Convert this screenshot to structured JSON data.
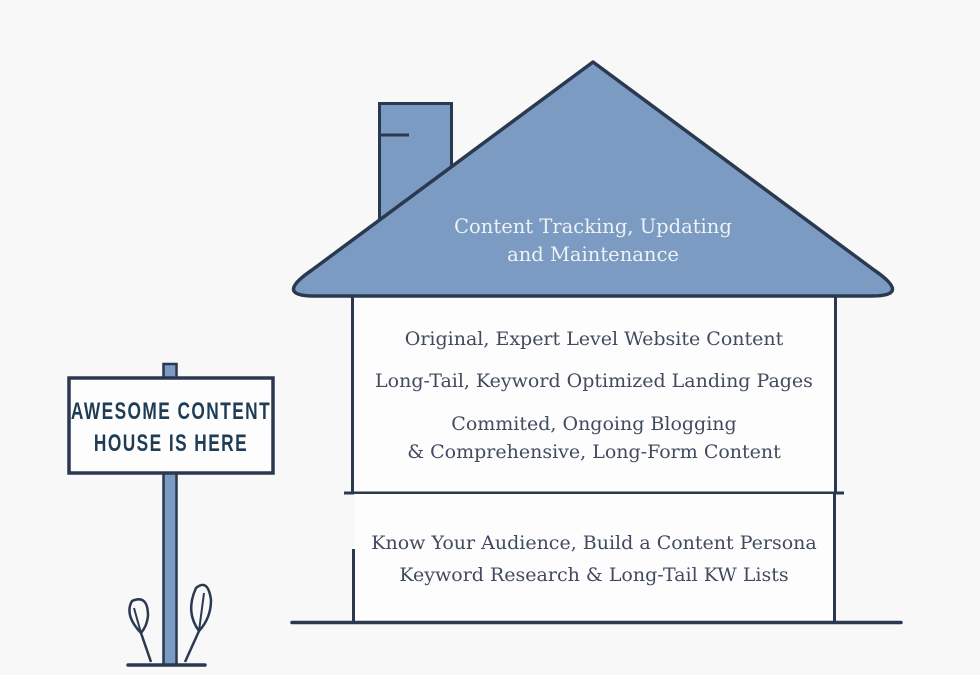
{
  "colors": {
    "background": "#f8f8f8",
    "roof_fill": "#7b9bc2",
    "outline": "#2b3950",
    "box_fill": "#fdfdfe",
    "body_text": "#414a5e",
    "roof_text": "#eff2f5",
    "sign_text": "#1f3c55"
  },
  "sign": {
    "line1": "AWESOME CONTENT",
    "line2": "HOUSE IS HERE"
  },
  "house": {
    "roof": {
      "line1": "Content Tracking, Updating",
      "line2": "and Maintenance"
    },
    "upper_floor": {
      "item1": "Original, Expert Level Website Content",
      "item2": "Long-Tail, Keyword Optimized Landing Pages",
      "item3_line1": "Commited, Ongoing Blogging",
      "item3_line2": "& Comprehensive, Long-Form Content"
    },
    "foundation": {
      "item1": "Know Your Audience, Build a Content Persona",
      "item2": "Keyword Research & Long-Tail KW Lists"
    }
  }
}
